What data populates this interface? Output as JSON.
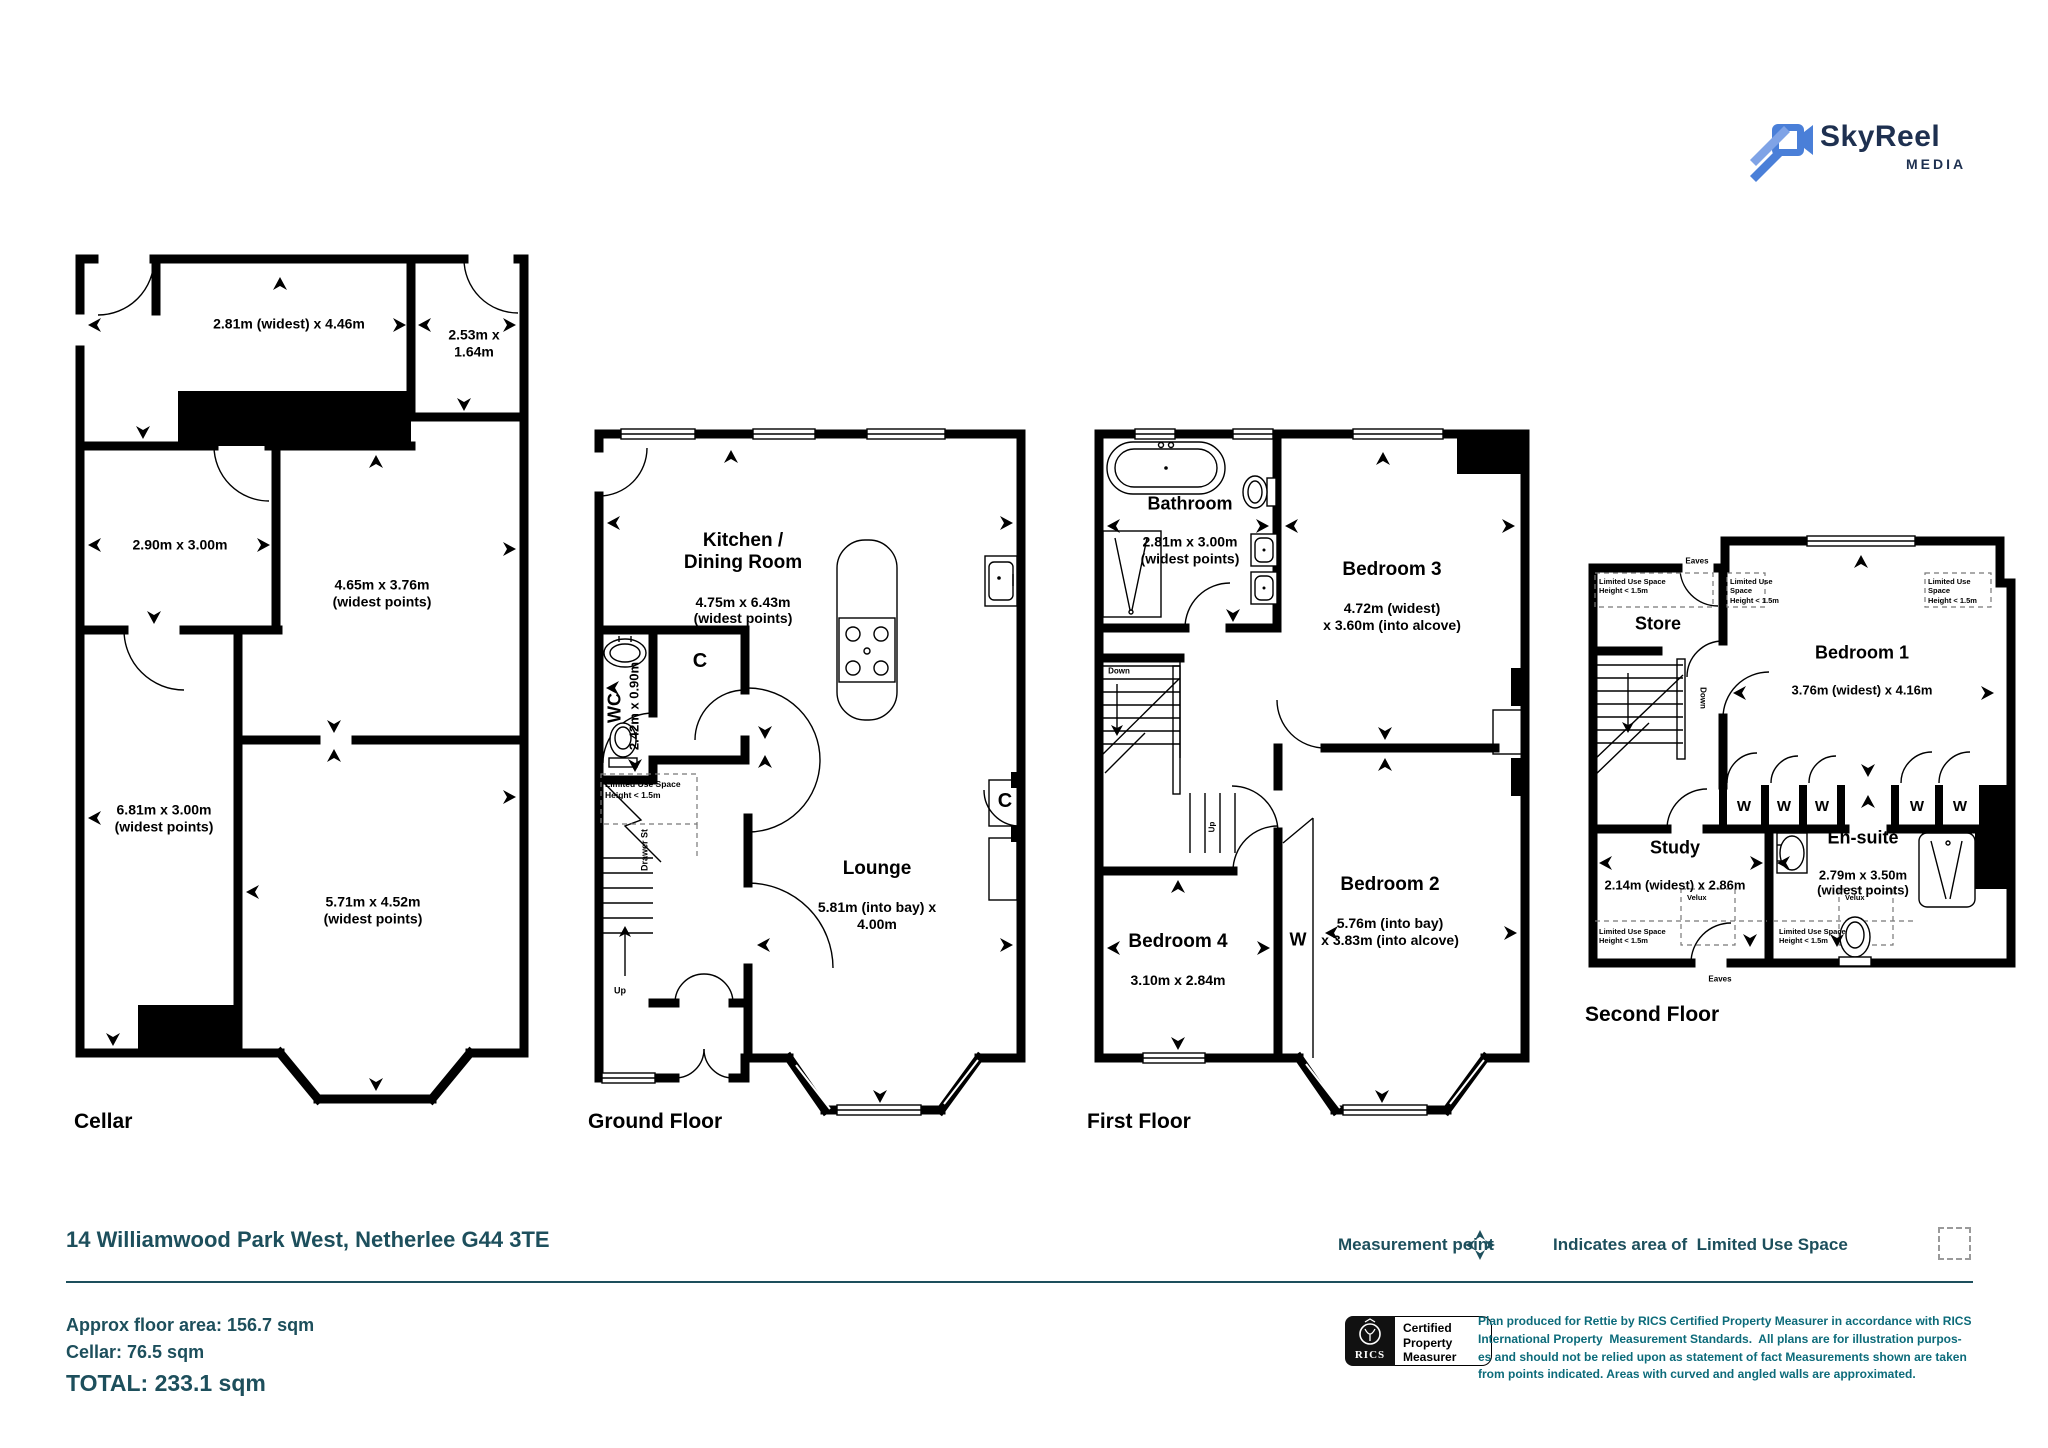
{
  "brand": {
    "title": "SkyReel",
    "subtitle": "MEDIA"
  },
  "address": "14 Williamwood Park West, Netherlee G44 3TE",
  "legend": {
    "measurement_point": "Measurement point",
    "limited_use_space": "Indicates area of  Limited Use Space"
  },
  "areas": {
    "approx": "Approx floor area: 156.7 sqm",
    "cellar": "Cellar: 76.5 sqm",
    "total": "TOTAL: 233.1 sqm"
  },
  "certification": {
    "org": "RICS",
    "label": "Certified\nProperty\nMeasurer"
  },
  "disclaimer": "Plan produced for Rettie by RICS Certified Property Measurer in accordance with RICS\nInternational Property  Measurement Standards.  All plans are for illustration purpos-\nes and should not be relied upon as statement of fact Measurements shown are taken\nfrom points indicated. Areas with curved and angled walls are approximated.",
  "floors": {
    "cellar": {
      "name": "Cellar",
      "rooms": {
        "r1": "2.81m (widest) x 4.46m",
        "r2": "2.53m x 1.64m",
        "r3": "2.90m x 3.00m",
        "r4": "4.65m x 3.76m\n(widest points)",
        "r5": "6.81m x 3.00m\n(widest points)",
        "r6": "5.71m x 4.52m\n(widest points)"
      }
    },
    "ground": {
      "name": "Ground Floor",
      "rooms": {
        "kitchen_name": "Kitchen /\nDining Room",
        "kitchen_dims": "4.75m x 6.43m\n(widest points)",
        "wc_name": "WC",
        "wc_dims": "2.42m x 0.90m",
        "lounge_name": "Lounge",
        "lounge_dims": "5.81m (into bay) x 4.00m",
        "closet": "C",
        "drawer": "Drawer St",
        "up": "Up",
        "lus": "Limited Use Space\nHeight < 1.5m"
      }
    },
    "first": {
      "name": "First Floor",
      "rooms": {
        "bathroom_name": "Bathroom",
        "bathroom_dims": "2.81m x 3.00m\n(widest points)",
        "bedroom3_name": "Bedroom 3",
        "bedroom3_dims": "4.72m (widest)\nx 3.60m (into alcove)",
        "bedroom2_name": "Bedroom 2",
        "bedroom2_dims": "5.76m (into bay)\nx 3.83m (into alcove)",
        "bedroom4_name": "Bedroom 4",
        "bedroom4_dims": "3.10m x 2.84m",
        "wardrobe": "W",
        "down": "Down",
        "up": "Up"
      }
    },
    "second": {
      "name": "Second Floor",
      "rooms": {
        "store": "Store",
        "bedroom1_name": "Bedroom 1",
        "bedroom1_dims": "3.76m (widest) x 4.16m",
        "study_name": "Study",
        "study_dims": "2.14m (widest) x 2.86m",
        "ensuite_name": "En-suite",
        "ensuite_dims": "2.79m x 3.50m\n(widest points)",
        "wardrobe": "W",
        "down": "Down",
        "eaves": "Eaves",
        "velux": "Velux",
        "lus": "Limited Use Space\nHeight < 1.5m"
      }
    }
  }
}
